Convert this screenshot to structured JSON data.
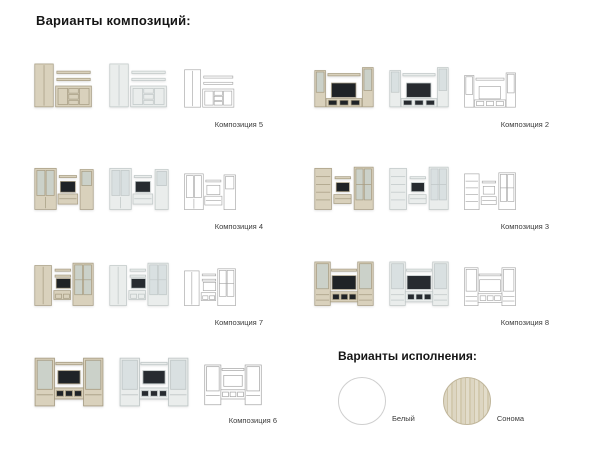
{
  "page": {
    "compositions_heading": "Варианты композиций:",
    "finishes_heading": "Варианты исполнения:"
  },
  "compositions": [
    {
      "label": "Композиция 5"
    },
    {
      "label": "Композиция 2"
    },
    {
      "label": "Композиция 4"
    },
    {
      "label": "Композиция 3"
    },
    {
      "label": "Композиция 7"
    },
    {
      "label": "Композиция 8"
    },
    {
      "label": "Композиция 6"
    }
  ],
  "finishes": [
    {
      "label": "Белый",
      "color": "#ffffff"
    },
    {
      "label": "Сонома",
      "color": "#d9d1bc"
    }
  ],
  "colors": {
    "background": "#ffffff",
    "sonoma_furniture": "#d9d1bc",
    "white_furniture": "#eaedec",
    "outline_line": "#a3a3a3",
    "tv_screen": "#1f2327",
    "heading_text": "#161616",
    "label_text": "#3c3c3c"
  }
}
